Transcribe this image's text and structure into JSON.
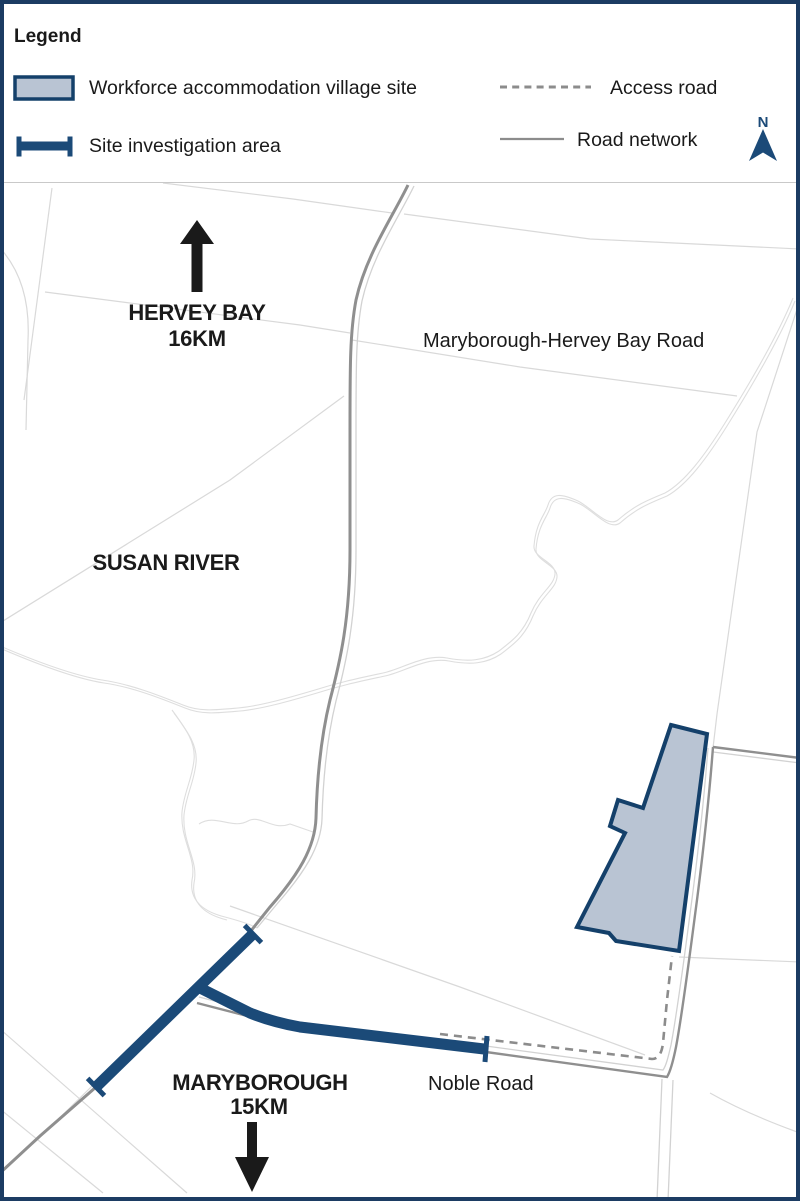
{
  "legend": {
    "title": "Legend",
    "village_site": "Workforce accommodation village site",
    "investigation_area": "Site investigation area",
    "access_road": "Access road",
    "road_network": "Road network",
    "north": "N"
  },
  "map_labels": {
    "hervey_bay_name": "HERVEY BAY",
    "hervey_bay_distance": "16KM",
    "main_road": "Maryborough-Hervey Bay Road",
    "locality": "SUSAN RIVER",
    "maryborough_name": "MARYBOROUGH",
    "maryborough_distance": "15KM",
    "noble_road": "Noble Road"
  },
  "colors": {
    "navy": "#1b4a78",
    "navy-dark": "#14406a",
    "border-navy": "#1c3c63",
    "site-fill": "#b9c4d3",
    "road-gray": "#8f8f8f",
    "road-light": "#d2d2d2",
    "parcel-gray": "#d9d9d9",
    "creek-gray": "#dedede",
    "dash-gray": "#8c8c8c",
    "text-black": "#1a1a1a"
  }
}
